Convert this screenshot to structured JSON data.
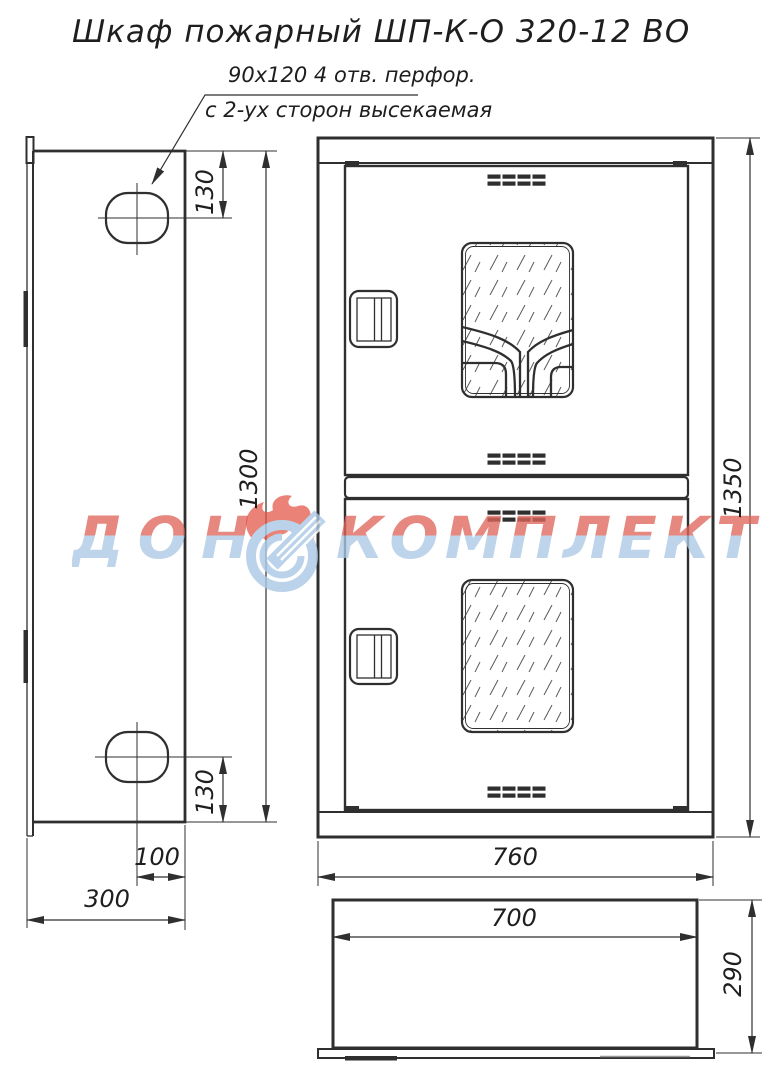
{
  "title": "Шкаф пожарный ШП-К-О 320-12 ВО",
  "annotation": {
    "line1": "90х120  4 отв. перфор.",
    "line2": "с 2-ух сторон высекаемая"
  },
  "watermark": {
    "word1": "ДОН",
    "word2": "КОМПЛЕКТ",
    "color_top": "#df675d",
    "color_bottom": "#abc9e6",
    "flame_color": "#e25648"
  },
  "dimensions": {
    "side_hole_top_offset": "130",
    "side_panel_height": "1300",
    "side_hole_bottom_offset": "130",
    "side_hole_edge_offset": "100",
    "side_panel_depth": "300",
    "front_overall_height": "1350",
    "front_overall_width": "760",
    "top_inner_width": "700",
    "top_depth": "290"
  },
  "colors": {
    "line": "#2f2f2f",
    "background": "#ffffff"
  }
}
